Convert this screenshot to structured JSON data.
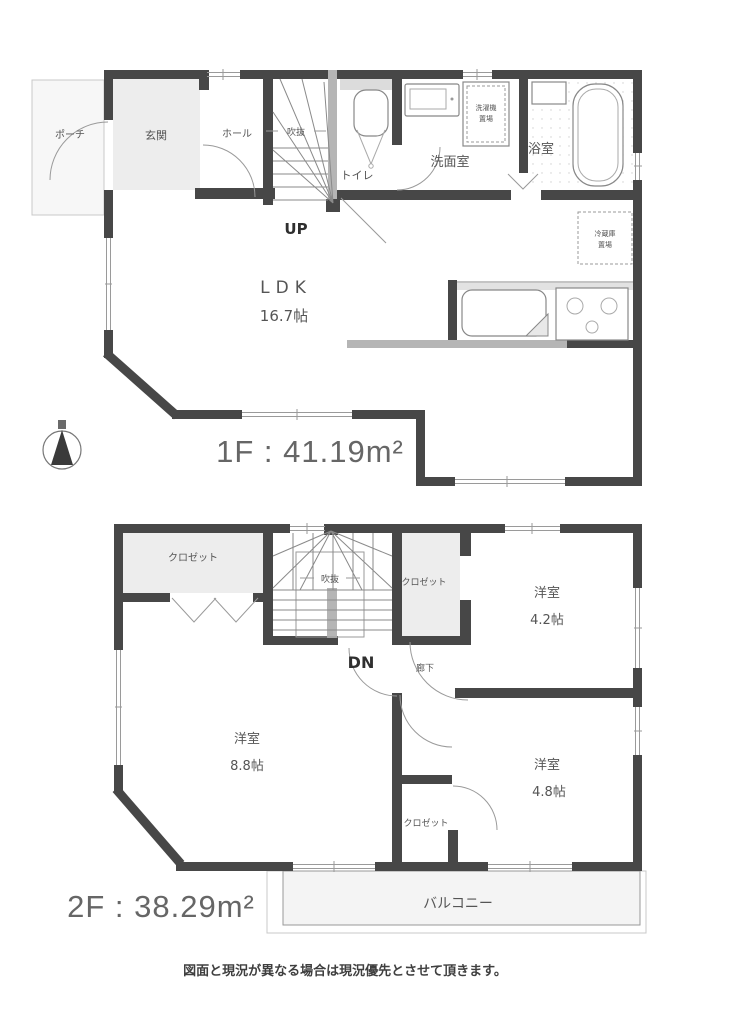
{
  "colors": {
    "wall": "#474747",
    "wall_light": "#b5b5b5",
    "floor_tint": "#ededed",
    "line": "#8a8a8a",
    "text": "#555555",
    "area_text": "#666666"
  },
  "icons": {
    "compass": "north-arrow-compass"
  },
  "floor1": {
    "area_label": "1F : 41.19m²",
    "labels": {
      "porch": "ポーチ",
      "entrance": "玄関",
      "hall": "ホール",
      "void": "吹抜",
      "toilet": "トイレ",
      "up": "UP",
      "washroom": "洗面室",
      "bathroom": "浴室",
      "washer_line1": "洗濯機",
      "washer_line2": "置場",
      "fridge_line1": "冷蔵庫",
      "fridge_line2": "置場",
      "ldk": "LDK",
      "ldk_size": "16.7帖"
    }
  },
  "floor2": {
    "area_label": "2F : 38.29m²",
    "labels": {
      "closet_left": "クロゼット",
      "closet_right": "クロゼット",
      "closet_small": "クロゼット",
      "void": "吹抜",
      "dn": "DN",
      "hallway": "廊下",
      "room_a": "洋室",
      "room_a_size": "4.2帖",
      "room_b": "洋室",
      "room_b_size": "8.8帖",
      "room_c": "洋室",
      "room_c_size": "4.8帖",
      "balcony": "バルコニー"
    }
  },
  "footer": {
    "disclaimer": "図面と現況が異なる場合は現況優先とさせて頂きます。"
  }
}
